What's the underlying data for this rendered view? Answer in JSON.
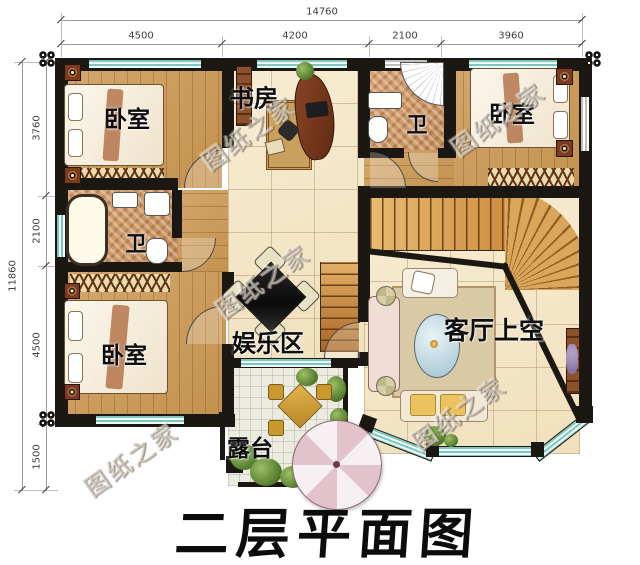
{
  "title": "二层平面图",
  "watermark": "图纸之家",
  "dimensions": {
    "top": {
      "total": "14760",
      "segments": [
        "4500",
        "4200",
        "2100",
        "3960"
      ]
    },
    "left": {
      "total": "11860",
      "segments": [
        "3760",
        "2100",
        "4500",
        "1500"
      ]
    }
  },
  "rooms": {
    "bedroom_tl": "卧室",
    "study": "书房",
    "bath_top": "卫",
    "bedroom_tr": "卧室",
    "bath_left": "卫",
    "bedroom_bl": "卧室",
    "entertainment": "娱乐区",
    "living_void": "客厅上空",
    "terrace": "露台"
  },
  "colors": {
    "wall": "#1b1712",
    "window_teal": "#7ec7bf",
    "wood_floor": "#cb9c5d",
    "tile_floor": "#f4e7cb",
    "mosaic_floor": "#cf9d68",
    "stair_wood": "#d9a558",
    "parasol_pink": "#e3c3cb",
    "plant_green": "#5d8136",
    "label_black": "#0d0d0d"
  }
}
